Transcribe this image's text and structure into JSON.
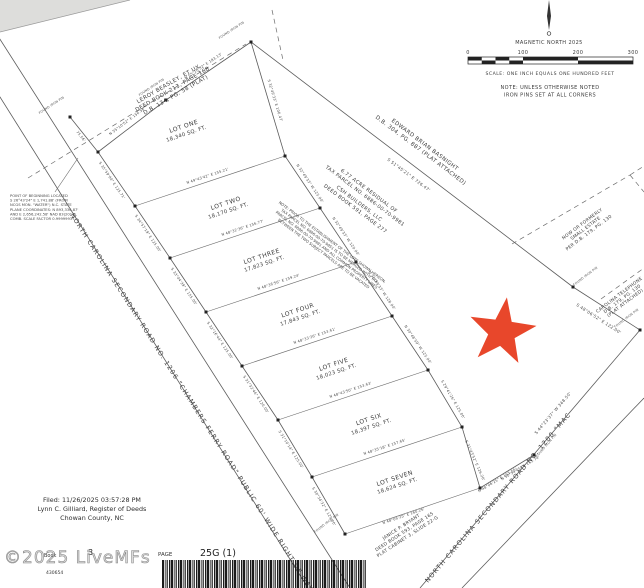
{
  "header": {
    "north_label": "MAGNETIC NORTH 2025",
    "scale_ticks": [
      "0",
      "100",
      "200",
      "300"
    ],
    "scale_caption": "SCALE: ONE INCH EQUALS ONE HUNDRED FEET",
    "note_line1": "NOTE: UNLESS OTHERWISE NOTED",
    "note_line2": "IRON PINS SET AT ALL CORNERS"
  },
  "lots": [
    {
      "name": "LOT ONE",
      "area": "18,340 SQ. FT."
    },
    {
      "name": "LOT TWO",
      "area": "18,170 SQ. FT."
    },
    {
      "name": "LOT THREE",
      "area": "17,823 SQ. FT."
    },
    {
      "name": "LOT FOUR",
      "area": "17,843 SQ. FT."
    },
    {
      "name": "LOT FIVE",
      "area": "18,023 SQ. FT."
    },
    {
      "name": "LOT SIX",
      "area": "18,397 SQ. FT."
    },
    {
      "name": "LOT SEVEN",
      "area": "18,624 SQ. FT."
    }
  ],
  "bearings": [
    "N 55°10'52\" E  156.56'",
    "N 55°10'52\" E  183.13'",
    "S 32°49'33\" E  106.47'",
    "N 49°43'42\" E  155.21'",
    "N 48°32'36\" E  156.77'",
    "N 48°36'56\" E  159.24'",
    "N 48°33'26\" E  153.61'",
    "N 48°43'50\" E  153.63'",
    "N 48°35'18\" E  157.65'",
    "N 48°06'25\" E  160.26'",
    "S 35°59'00\" E  125.71'",
    "S 34°57'19\" E  125.00'",
    "S 33°04'39\" E  155.00'",
    "S 32°16'44\" E  125.00'",
    "S 31°32'46\" E  120.00'",
    "S 31°10'14\" E  125.00'",
    "S 30°34'32\" E  125.00'",
    "N 32°49'33\" W  125.00'",
    "N 32°49'33\" W  120.00'",
    "N 32°49'33\" W  128.00'",
    "N 30°48'59\" W  125.00'",
    "S 29°41'26\" E  125.00'",
    "S 31°43'52\" E  126.26'",
    "S 51°45'21\" E  726.47'",
    "S 48°06'52\" E  122.00'",
    "S 44°23'37\" W  348.50'",
    "N 48°06'25\" E  163.55'",
    "N 50°54'05\" E  153.74'",
    "75.56'"
  ],
  "labels": {
    "found_iron_pin": "FOUND IRON PIN"
  },
  "parcels": {
    "beasley": [
      "LEROY BEASLEY, ET UX.",
      "DEED BOOK 213, PAGE 168",
      "D.B. 134, PG. 58 (PLAT)"
    ],
    "basnight": [
      "EDWARD BRIAN BASNIGHT",
      "D.B. 304, PG. 887 (PLAT ATTACHED)"
    ],
    "residual": [
      "6.77 ACRE RESIDUAL OF",
      "TAX PARCEL NO. 6886-00-70-9981",
      "CSH BUILDERS, LLC",
      "DEED BOOK 591, PAGE 277"
    ],
    "merge_note": [
      "NOTE: PRIOR TO THE ESTABLISHMENT OF THE LOTS SHOWN HEREON,",
      "TAX PARCEL NO. 6886-00-70-9851 IS TO BE MERGED WITH TAX",
      "PARCEL NO. 6886-00-70-9981 AND ALL COMMON PROPERTY LINES",
      "BETWEEN THE TWO SUBJECT PARCELS ARE TO BE VACATED"
    ],
    "small_estate": [
      "NOW OR FORMERLY",
      "SMALL ESTATE",
      "PER D.B. 179, PG. 130"
    ],
    "carolina_telephone": [
      "CAROLINA TELEPHONE",
      "D.B. 179, PG. 130",
      "(PLAT ATTACHED)"
    ],
    "bryant": [
      "JANICE P. BRYANT",
      "DEED BOOK 593, PAGE 165",
      "PLAT CABINET 3, SLIDE 22-G"
    ]
  },
  "roads": {
    "road1": "NORTH CAROLINA SECONDARY ROAD NO. 1206 \"CHAMBERS FERRY ROAD\" PUBLIC 60' WIDE RIGHT OF WAY",
    "road2": "NORTH CAROLINA SECONDARY ROAD NO. 1200 \"MAC"
  },
  "pob_note": [
    "POINT OF BEGINNING LOCATED",
    "S 26°43'24\" E 1,741.88' (FROM",
    "NCGS MON. \"WATER\") N.C. STATE",
    "PLANE COORDINATES: N 893,336.87'",
    "AND E 2,656,242.58' NAD 83(2011).",
    "COMB. SCALE FACTOR 0.99999937"
  ],
  "filing": {
    "line1": "Filed: 11/26/2025 03:57:28 PM",
    "line2": "Lynn C. Gilliard, Register of Deeds",
    "line3": "Chowan County, NC"
  },
  "record": {
    "book_label": "Book",
    "book": "3",
    "page_label": "PAGE",
    "page": "25G (1)",
    "doc_number": "430654"
  },
  "watermark": "©2025 LiveMFs",
  "colors": {
    "star": "#e8472b",
    "line": "#5c5c5c"
  }
}
